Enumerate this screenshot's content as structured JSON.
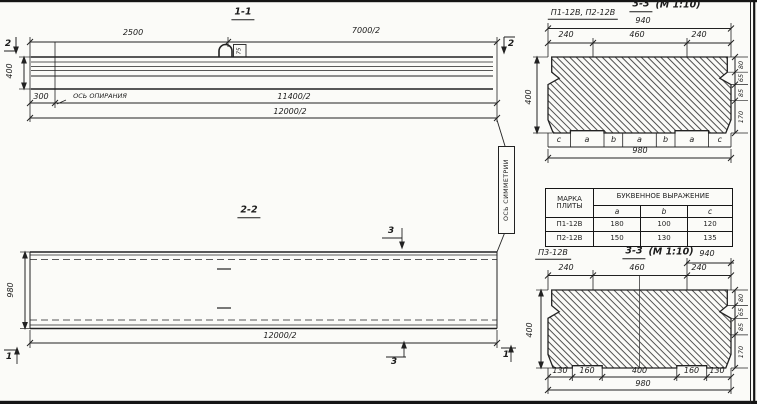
{
  "section_1_1": {
    "title": "1-1",
    "cut_marker": "2",
    "dim_top_left": "2500",
    "dim_top_right": "7000/2",
    "dim_height": "400",
    "hook_label": "75",
    "dim_support_offset": "300",
    "support_axis_label": "ОСЬ ОПИРАНИЯ",
    "dim_support_span": "11400/2",
    "dim_total": "12000/2"
  },
  "section_2_2": {
    "title": "2-2",
    "cut_marker_3": "3",
    "cut_marker_1": "1",
    "dim_width": "980",
    "dim_total": "12000/2",
    "symmetry_axis_label": "ОСЬ СИММЕТРИИ"
  },
  "section_3_3_top": {
    "plates_label": "П1-12В, П2-12В",
    "title": "3-3",
    "scale": "(М 1:10)",
    "dim_top_total": "940",
    "dims_top": [
      "240",
      "460",
      "240"
    ],
    "dim_height": "400",
    "dims_right": [
      "80",
      "65",
      "85",
      "170"
    ],
    "letters": [
      "c",
      "a",
      "b",
      "a",
      "b",
      "a",
      "c"
    ],
    "dim_bottom_total": "980"
  },
  "plate_table": {
    "header_mark": "МАРКА ПЛИТЫ",
    "header_expression": "БУКВЕННОЕ ВЫРАЖЕНИЕ",
    "columns": [
      "a",
      "b",
      "c"
    ],
    "rows": [
      {
        "mark": "П1-12В",
        "a": "180",
        "b": "100",
        "c": "120"
      },
      {
        "mark": "П2-12В",
        "a": "150",
        "b": "130",
        "c": "135"
      }
    ]
  },
  "section_3_3_bottom": {
    "plate_label": "П3-12В",
    "title": "3-3",
    "scale": "(М 1:10)",
    "dim_top_total": "940",
    "dims_top": [
      "240",
      "460",
      "240"
    ],
    "dim_height": "400",
    "dims_right": [
      "80",
      "65",
      "85",
      "170"
    ],
    "dims_bottom": [
      "130",
      "160",
      "400",
      "160",
      "130"
    ],
    "dim_bottom_total": "980"
  }
}
